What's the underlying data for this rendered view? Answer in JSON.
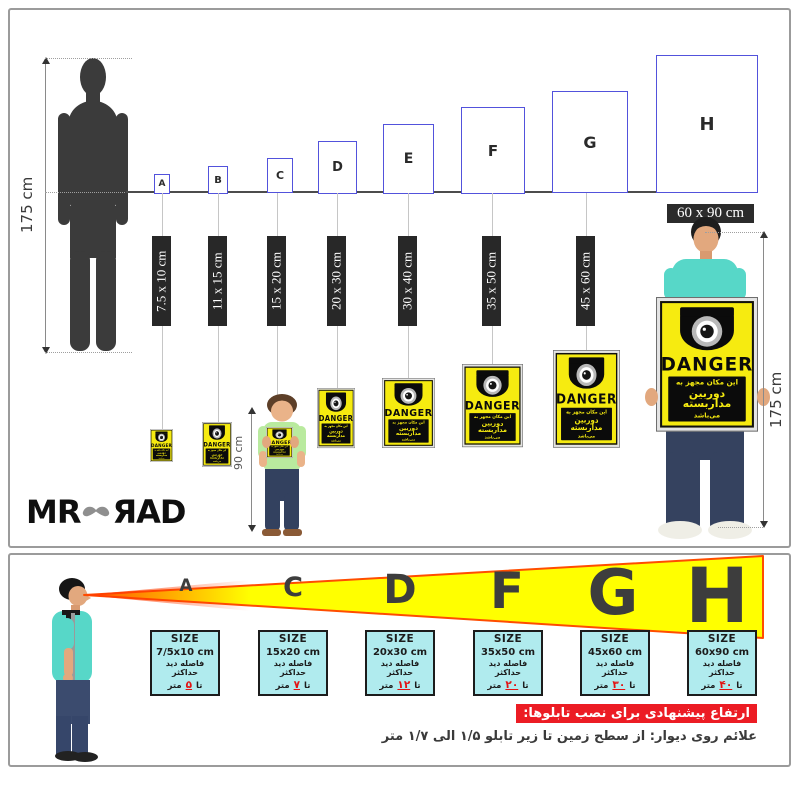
{
  "top_panel": {
    "left_height_label": "175 cm",
    "right_height_label": "175 cm",
    "child_height_label": "90 cm",
    "h_size_label": "60 x 90 cm",
    "logo_left": "MR",
    "logo_right": "ЯAD",
    "sizes": [
      {
        "letter": "A",
        "size_label": "7.5 x 10 cm"
      },
      {
        "letter": "B",
        "size_label": "11 x 15 cm"
      },
      {
        "letter": "C",
        "size_label": "15 x 20 cm"
      },
      {
        "letter": "D",
        "size_label": "20 x 30 cm"
      },
      {
        "letter": "E",
        "size_label": "30 x 40 cm"
      },
      {
        "letter": "F",
        "size_label": "35 x 50 cm"
      },
      {
        "letter": "G",
        "size_label": "45 x 60 cm"
      },
      {
        "letter": "H",
        "size_label": "60 x 90 cm"
      }
    ]
  },
  "sign": {
    "danger_label": "DANGER",
    "line1": "این مکان مجهز به",
    "line2": "دوربین مداربسته",
    "line3": "می‌باشد"
  },
  "viewing": {
    "letters": [
      "A",
      "C",
      "D",
      "F",
      "G",
      "H"
    ],
    "size_title": "SIZE",
    "distance_label": "فاصله دید حداکثر",
    "distance_prefix": "تا",
    "distance_suffix": "متر",
    "boxes": [
      {
        "size": "7/5x10 cm",
        "distance": "۵"
      },
      {
        "size": "15x20 cm",
        "distance": "۷"
      },
      {
        "size": "20x30 cm",
        "distance": "۱۲"
      },
      {
        "size": "35x50 cm",
        "distance": "۲۰"
      },
      {
        "size": "45x60 cm",
        "distance": "۳۰"
      },
      {
        "size": "60x90 cm",
        "distance": "۴۰"
      }
    ],
    "note_title": "ارتفاع پیشنهادی برای نصب تابلوها:",
    "note_body": "علائم روی دیوار: از سطح زمین تا زیر تابلو ۱/۵ الی ۱/۷ متر"
  },
  "colors": {
    "sign_yellow": "#f6eb10",
    "cone_yellow": "#ffff00",
    "cone_border": "#ff4d00",
    "box_cyan": "#b0ebee",
    "note_red": "#ec1c24",
    "rect_blue": "#5252dc",
    "label_dark": "#282828"
  }
}
